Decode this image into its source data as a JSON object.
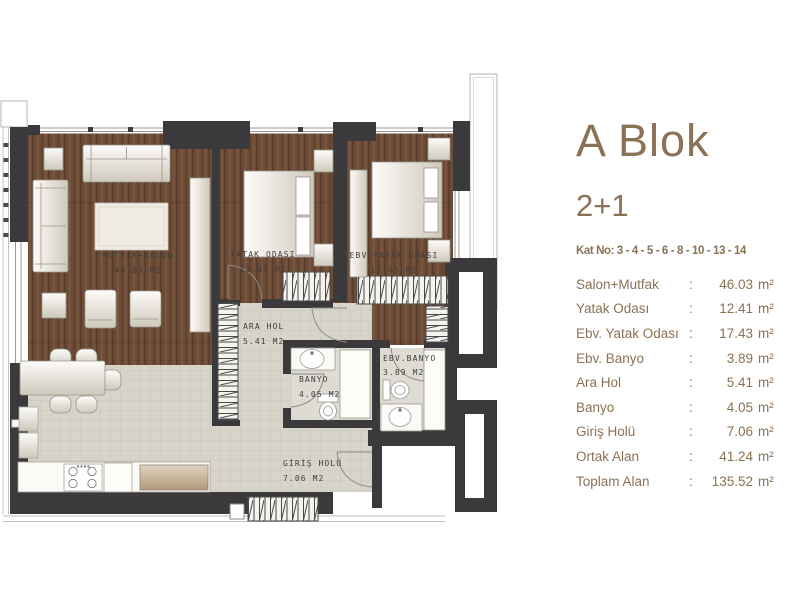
{
  "panel": {
    "title": "A Blok",
    "subtitle": "2+1",
    "kat_no": "Kat No: 3 - 4 - 5 - 6 - 8 - 10 - 13 - 14",
    "colon": ":",
    "rows": [
      {
        "label": "Salon+Mutfak",
        "value": "46.03",
        "unit": "m²"
      },
      {
        "label": "Yatak Odası",
        "value": "12.41",
        "unit": "m²"
      },
      {
        "label": "Ebv. Yatak Odası",
        "value": "17.43",
        "unit": "m²"
      },
      {
        "label": "Ebv. Banyo",
        "value": "3.89",
        "unit": "m²"
      },
      {
        "label": "Ara Hol",
        "value": "5.41",
        "unit": "m²"
      },
      {
        "label": "Banyo",
        "value": "4.05",
        "unit": "m²"
      },
      {
        "label": "Giriş Holü",
        "value": "7.06",
        "unit": "m²"
      },
      {
        "label": "Ortak Alan",
        "value": "41.24",
        "unit": "m²"
      },
      {
        "label": "Toplam Alan",
        "value": "135.52",
        "unit": "m²"
      }
    ]
  },
  "plan": {
    "rooms": [
      {
        "name": "MUTFAK+SALON",
        "area": "44.03 M2"
      },
      {
        "name": "YATAK ODASI",
        "area": "12.41 M2"
      },
      {
        "name": "EBV.YATAK ODASI",
        "area": "17.43 M2"
      },
      {
        "name": "ARA HOL",
        "area": "5.41 M2"
      },
      {
        "name": "BANYO",
        "area": "4.05 M2"
      },
      {
        "name": "EBV.BANYO",
        "area": "3.89 M2"
      },
      {
        "name": "GİRİŞ HOLÜ",
        "area": "7.06 M2"
      }
    ]
  },
  "colors": {
    "accent_brown": "#8B7156",
    "wall_dark": "#3A3A3C",
    "floor_wood": "#6D4C37",
    "floor_light": "#D8D4CA",
    "label_gray": "#3E3E3E"
  }
}
